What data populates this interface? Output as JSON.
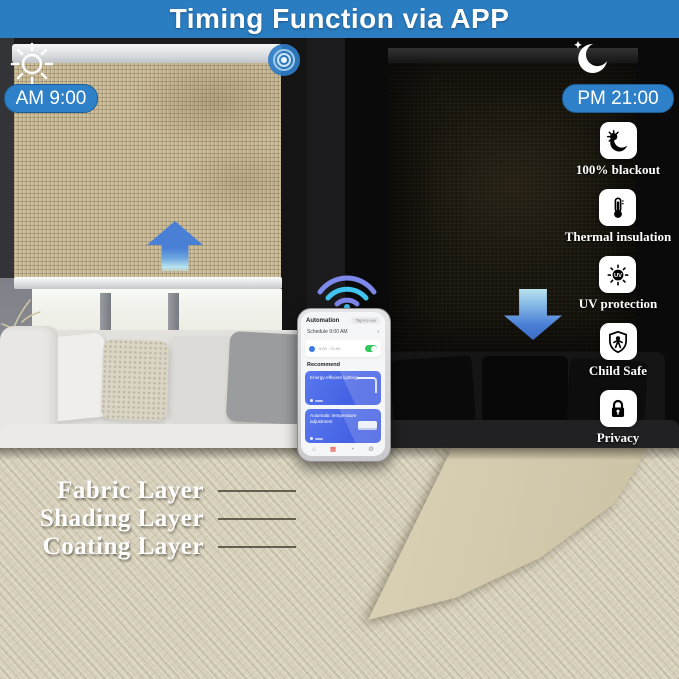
{
  "banner": {
    "title": "Timing Function via APP"
  },
  "day": {
    "time_label": "AM 9:00"
  },
  "night": {
    "time_label": "PM 21:00"
  },
  "features": [
    {
      "label": "100% blackout",
      "icon": "blackout-sun-moon-icon"
    },
    {
      "label": "Thermal insulation",
      "icon": "thermometer-icon"
    },
    {
      "label": "UV protection",
      "icon": "uv-sun-icon"
    },
    {
      "label": "Child Safe",
      "icon": "child-shield-icon"
    },
    {
      "label": "Privacy",
      "icon": "padlock-icon"
    }
  ],
  "phone_app": {
    "tab_automation": "Automation",
    "tab_tap_to_run": "Tap-to-run",
    "schedule_title": "Schedule 9:00 AM",
    "schedule_chevron": "›",
    "schedule_times": "9:00 - 21:00",
    "recommend_label": "Recommend",
    "card1_title": "Energy-efficient lighting",
    "card2_title": "Automatic temperature adjustment"
  },
  "layers": [
    {
      "label": "Fabric Layer"
    },
    {
      "label": "Shading Layer"
    },
    {
      "label": "Coating Layer"
    }
  ],
  "colors": {
    "banner_blue": "#2b7dc1",
    "pill_blue": "#2e81c8",
    "arrow_blue": "#4a7fd6",
    "wifi_cyan": "#41c4f0",
    "wifi_periwinkle": "#7e88ea",
    "toggle_green": "#34c759",
    "nav_active_red": "#e8453c"
  }
}
